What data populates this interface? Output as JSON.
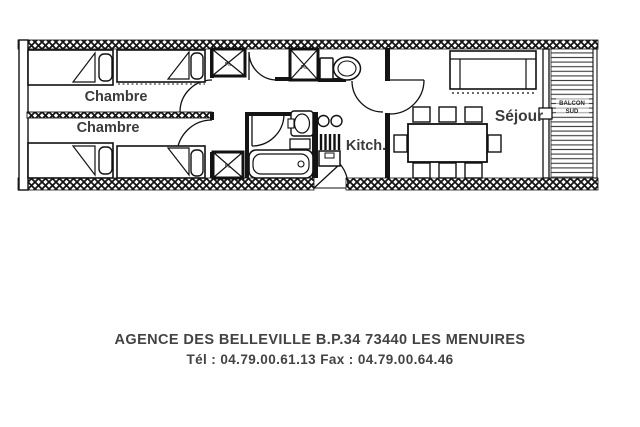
{
  "plan": {
    "labels": {
      "chambre_top": "Chambre",
      "chambre_bottom": "Chambre",
      "kitchen": "Kitch.",
      "living": "Séjour",
      "balcony_line1": "BALCON",
      "balcony_line2": "SUD",
      "closet": "Pl."
    },
    "colors": {
      "wall": "#1a1a1a",
      "room_label": "#3b3b3b",
      "background": "#ffffff"
    }
  },
  "footer": {
    "line1": "AGENCE DES BELLEVILLE B.P.34 73440 LES MENUIRES",
    "line2": "Tél : 04.79.00.61.13  Fax : 04.79.00.64.46"
  }
}
